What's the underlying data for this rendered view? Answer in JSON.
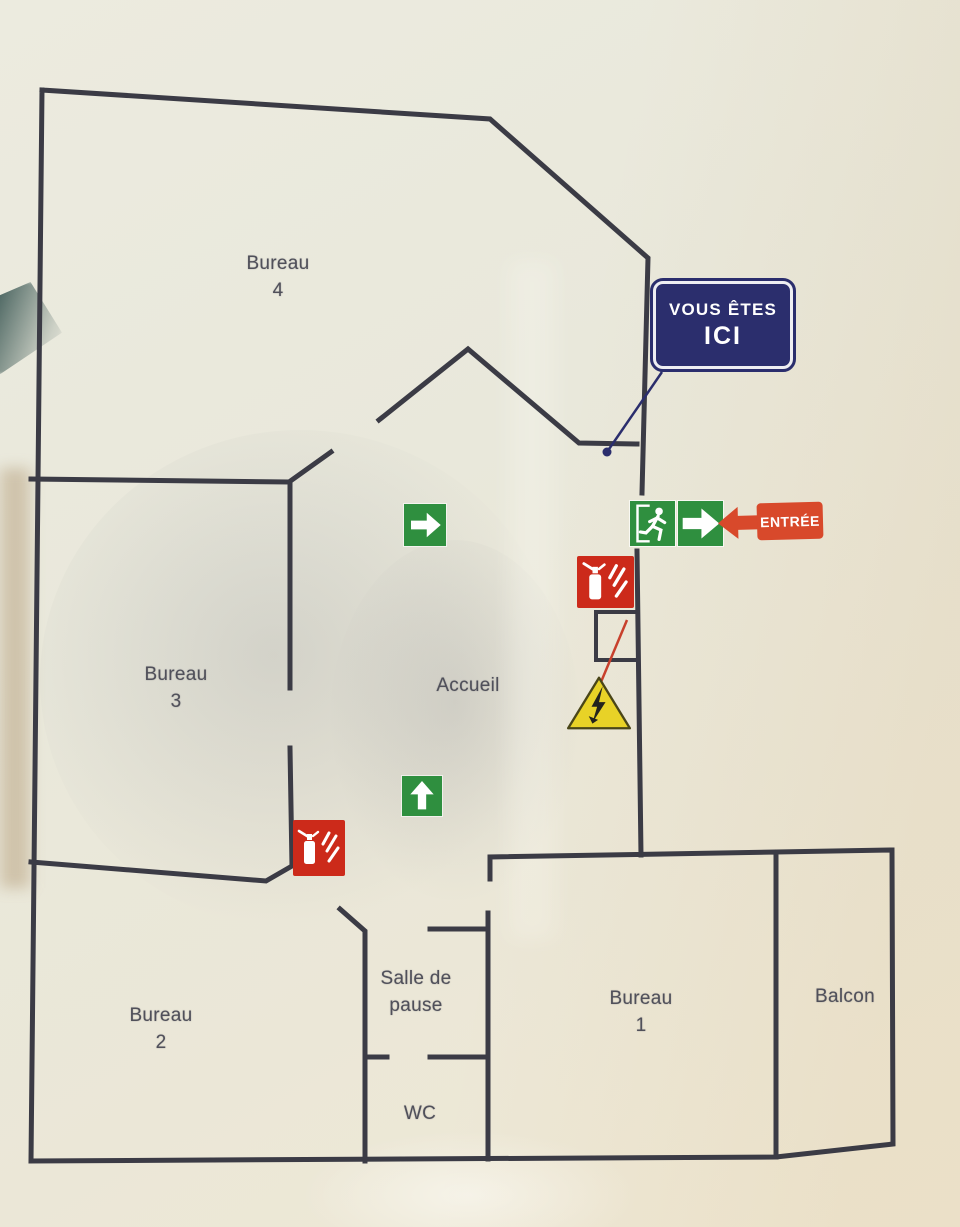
{
  "plan": {
    "type": "plan-evacuation-bureaux",
    "language": "fr"
  },
  "rooms": {
    "bureau4": {
      "name": "Bureau",
      "number": "4"
    },
    "bureau3": {
      "name": "Bureau",
      "number": "3"
    },
    "bureau2": {
      "name": "Bureau",
      "number": "2"
    },
    "bureau1": {
      "name": "Bureau",
      "number": "1"
    },
    "accueil": {
      "name": "Accueil"
    },
    "salle_de_pause": {
      "line1": "Salle de",
      "line2": "pause"
    },
    "wc": {
      "name": "WC"
    },
    "balcon": {
      "name": "Balcon"
    }
  },
  "signs": {
    "you_are_here": {
      "line1": "VOUS ÊTES",
      "line2": "ICI"
    },
    "entrance": {
      "label": "ENTRÉE"
    }
  },
  "icons": {
    "exit_running_man": "exit-running-man",
    "exit_arrow_right": "→",
    "direction_arrow_right": "→",
    "direction_arrow_up": "↑",
    "entrance_arrow_left": "←",
    "fire_extinguisher": "fire-extinguisher",
    "electrical_hazard": "⚡"
  },
  "colors": {
    "wall": "#3b3b45",
    "paper": "#e9e7da",
    "room_label": "#50505a",
    "exit_green": "#2f8f3f",
    "safety_red": "#cc2a1a",
    "entrance_orange": "#d8492b",
    "you_are_here_navy": "#2b2e6d",
    "hazard_yellow": "#e8d227"
  }
}
